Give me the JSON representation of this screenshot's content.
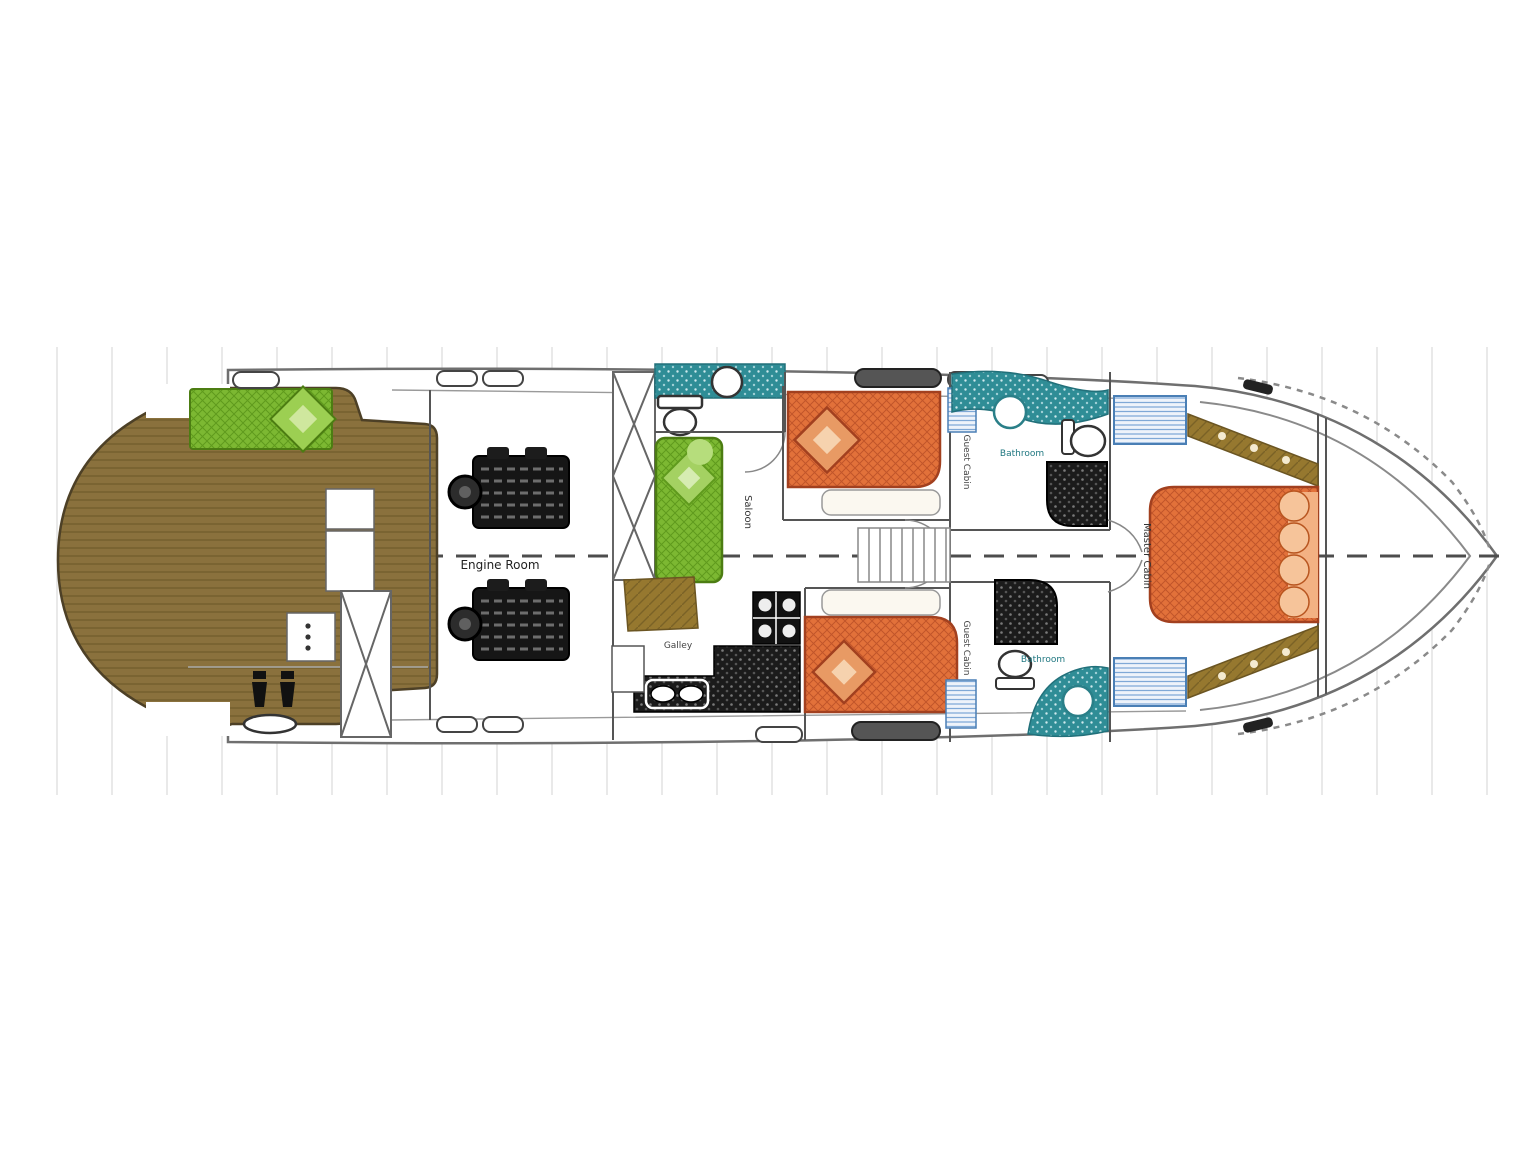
{
  "plan": {
    "type": "yacht-lower-deck-floor-plan",
    "labels": {
      "engine_room": "Engine Room",
      "galley": "Galley",
      "saloon": "Saloon",
      "guest_cabin_aft": "Guest Cabin",
      "guest_cabin_fwd": "Guest Cabin",
      "bathroom_top": "Bathroom",
      "bathroom_bottom": "Bathroom",
      "master_cabin": "Master Cabin"
    },
    "colors": {
      "swim_platform_teak": "#8a713d",
      "deck_seating_green": "#7cb832",
      "bed_upholstery_orange": "#e2713a",
      "bathroom_teal": "#2f8d96",
      "galley_counter_black": "#1b1b1b",
      "wood_cabinetry": "#96782f",
      "locker_stripe_blue": "#4a7fb5",
      "hull_outline_gray": "#777777"
    }
  }
}
